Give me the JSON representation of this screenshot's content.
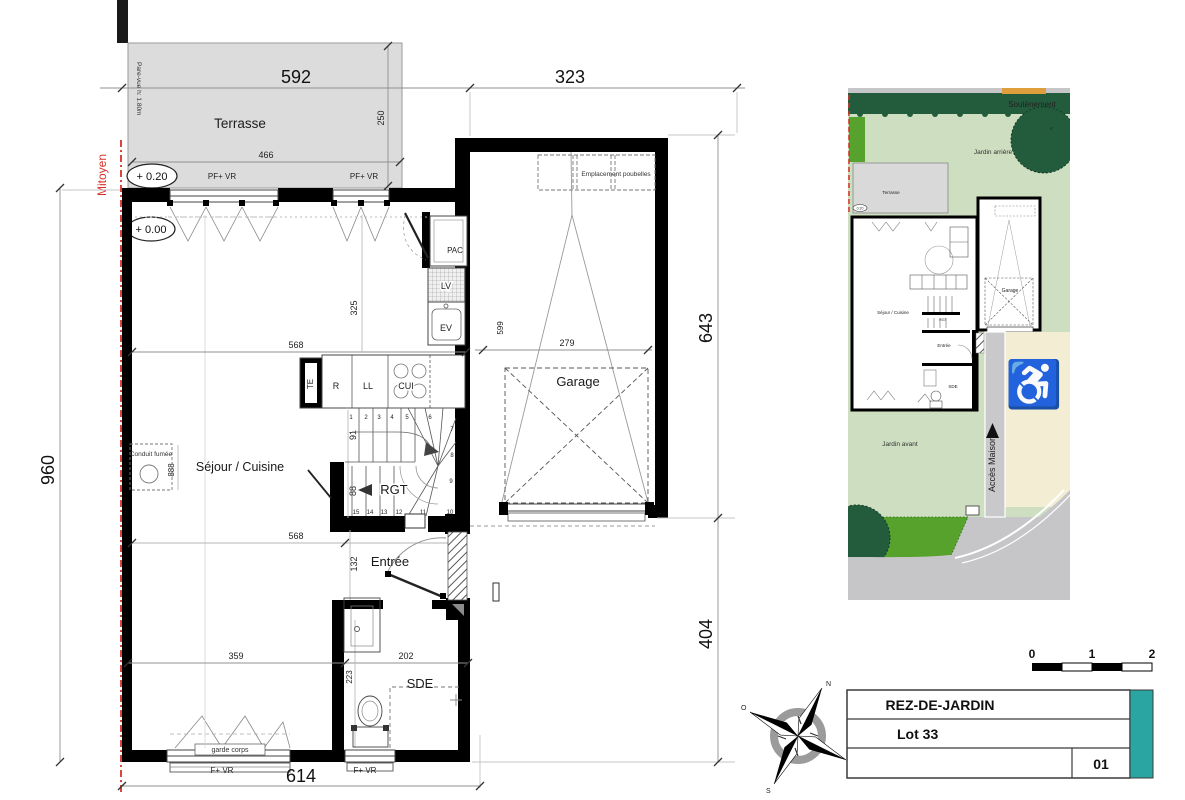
{
  "main_plan": {
    "room_labels": {
      "terrasse": "Terrasse",
      "sejour": "Séjour / Cuisine",
      "garage": "Garage",
      "entree": "Entrée",
      "sde": "SDE",
      "rgt": "RGT"
    },
    "fixture_labels": {
      "pac": "PAC",
      "lv": "LV",
      "ev": "EV",
      "te": "TE",
      "r": "R",
      "ll": "LL",
      "cui": "CUI",
      "conduit": "Conduit fumée",
      "emplacement": "Emplacement poubelles",
      "garde_corps": "garde corps"
    },
    "window_labels": {
      "pf_vr_left": "PF+ VR",
      "pf_vr_right": "PF+ VR",
      "f_vr_left": "F+ VR",
      "f_vr_right": "F+ VR"
    },
    "levels": {
      "terrace": "+ 0.20",
      "ground": "+ 0.00"
    },
    "boundary": {
      "mitoyen": "Mitoyen",
      "pare_vue": "Pare-vue h: 1.80m"
    },
    "dimensions": {
      "d592": "592",
      "d323": "323",
      "d466": "466",
      "d250": "250",
      "d960": "960",
      "d614": "614",
      "d643": "643",
      "d404": "404",
      "d568_top": "568",
      "d568_bottom": "568",
      "d359": "359",
      "d202": "202",
      "d325": "325",
      "d888": "888",
      "d132": "132",
      "d223": "223",
      "d91": "91",
      "d88": "88",
      "d279": "279",
      "d599": "599"
    },
    "stairs": [
      "1",
      "2",
      "3",
      "4",
      "5",
      "6",
      "7",
      "8",
      "9",
      "10",
      "11",
      "12",
      "13",
      "14",
      "15"
    ]
  },
  "site_plan": {
    "labels": {
      "soutenement": "Soutènement",
      "jardin_arriere": "Jardin arrière",
      "terrasse": "Terrasse",
      "sejour": "Séjour / Cuisine",
      "rgt": "RGT",
      "entree": "Entrée",
      "sde": "SDE",
      "garage": "Garage",
      "jardin_avant": "Jardin avant",
      "acces_maison": "Accès Maison",
      "tree_mark": "x"
    },
    "levels": {
      "terrace": "0.20",
      "ground": "0.00"
    },
    "handicap": "♿"
  },
  "title_block": {
    "floor_name": "REZ-DE-JARDIN",
    "lot": "Lot 33",
    "sheet_number": "01"
  },
  "scale_bar": {
    "t0": "0",
    "t1": "1",
    "t2": "2"
  },
  "compass": {
    "n": "N",
    "s": "S",
    "e": "E",
    "o": "O"
  },
  "colors": {
    "wall": "#000000",
    "terrace_fill": "#dcdcdc",
    "mitoyen_red": "#d8312a",
    "garden_light": "#cedec0",
    "garden_bright": "#56a22c",
    "garden_dark": "#235c3c",
    "road_gray": "#c6c6c8",
    "parking_beige": "#f3eed3",
    "accent_teal": "#2ba5a1"
  }
}
